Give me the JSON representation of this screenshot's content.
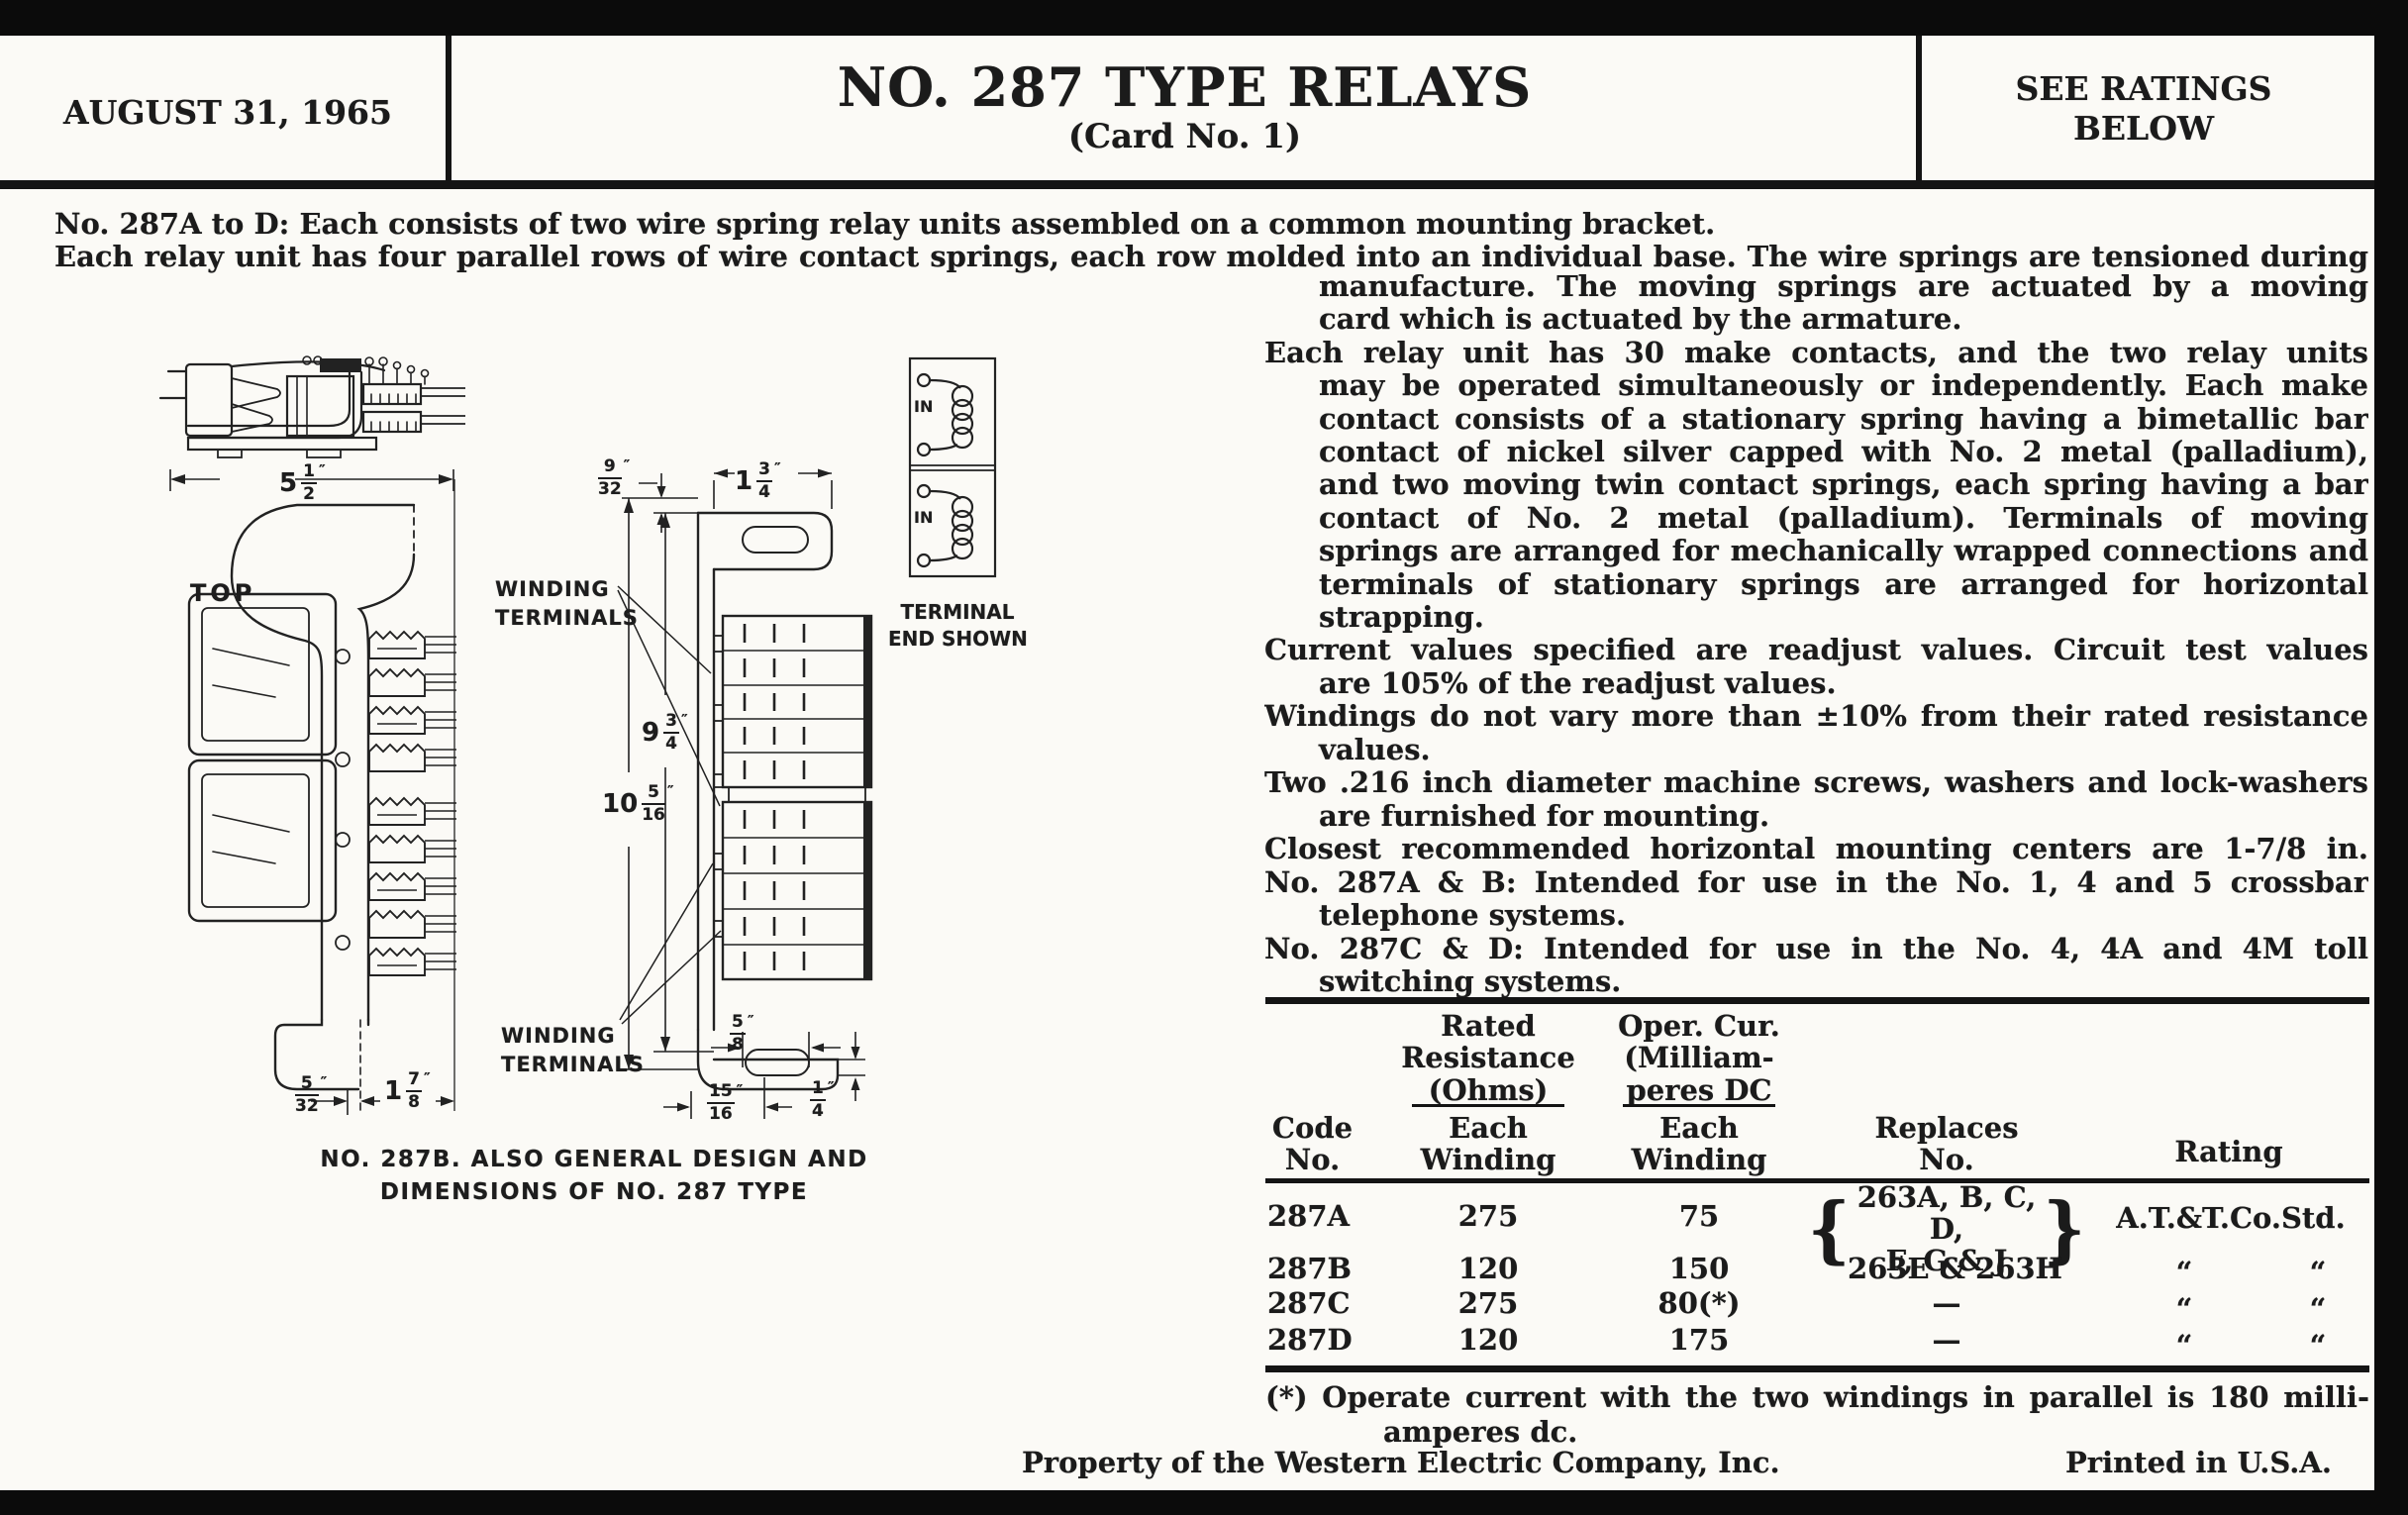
{
  "colors": {
    "paper": "#fbfaf6",
    "ink": "#1b1b1b",
    "border": "#0b0b0b"
  },
  "header": {
    "date": "AUGUST 31, 1965",
    "title": "NO. 287 TYPE RELAYS",
    "subtitle": "(Card No. 1)",
    "ratings_l1": "SEE RATINGS",
    "ratings_l2": "BELOW"
  },
  "intro": {
    "line1": "No. 287A to D:  Each consists of two wire spring relay units assembled on a common mounting bracket.",
    "line2": "Each relay unit has four parallel rows of wire contact springs, each row molded into an individual base.  The wire springs are tensioned during"
  },
  "column": {
    "lines": [
      "manufacture.  The moving springs are actuated by a moving",
      "card which is actuated by the armature.",
      "Each relay unit has 30 make contacts, and the two relay units",
      "may be operated simultaneously or independently.  Each make",
      "contact consists of a stationary spring having a bimetallic bar",
      "contact of nickel silver capped with No. 2 metal (palladium),",
      "and two moving twin contact springs, each spring having a bar",
      "contact of No. 2 metal (palladium).  Terminals of moving",
      "springs are arranged for mechanically wrapped connections and",
      "terminals of stationary springs are arranged for horizontal",
      "strapping.",
      "Current values specified are readjust values.  Circuit test values",
      "are 105% of the readjust values.",
      "Windings do not vary more than ±10% from their rated resistance",
      "values.",
      "Two .216 inch diameter machine screws, washers and lock-washers",
      "are furnished for mounting.",
      "Closest recommended horizontal mounting centers are 1-7/8 in.",
      "No. 287A & B:  Intended for use in the No. 1, 4 and 5 crossbar",
      "telephone systems.",
      "No. 287C & D:  Intended for use in the No. 4, 4A and 4M toll",
      "switching systems."
    ]
  },
  "drawing": {
    "top_view_label": "TOP",
    "winding_terminals_l1": "WINDING",
    "winding_terminals_l2": "TERMINALS",
    "terminal_end_l1": "TERMINAL",
    "terminal_end_l2": "END SHOWN",
    "coil_in": "IN",
    "caption_l1": "NO. 287B. ALSO GENERAL DESIGN AND",
    "caption_l2": "DIMENSIONS OF NO. 287 TYPE",
    "inch_mark": "″",
    "dims": {
      "overall_width": {
        "w": "5",
        "n": "1",
        "d": "2"
      },
      "bracket_offset": {
        "w": "",
        "n": "9",
        "d": "32"
      },
      "bracket_width": {
        "w": "1",
        "n": "3",
        "d": "4"
      },
      "terminal_span": {
        "w": "9",
        "n": "3",
        "d": "4"
      },
      "overall_height": {
        "w": "10",
        "n": "5",
        "d": "16"
      },
      "slot_width": {
        "w": "",
        "n": "5",
        "d": "8"
      },
      "slot_center": {
        "w": "",
        "n": "15",
        "d": "16"
      },
      "foot_offset": {
        "w": "",
        "n": "1",
        "d": "4"
      },
      "base_offset": {
        "w": "",
        "n": "5",
        "d": "32"
      },
      "depth": {
        "w": "1",
        "n": "7",
        "d": "8"
      }
    }
  },
  "table": {
    "headers": {
      "code_l1": "Code",
      "code_l2": "No.",
      "res_l1": "Rated",
      "res_l2": "Resistance",
      "res_l3": "(Ohms)",
      "cur_l1": "Oper. Cur.",
      "cur_l2": "(Milliam-",
      "cur_l3": "peres DC",
      "each": "Each",
      "winding": "Winding",
      "replaces_l1": "Replaces",
      "replaces_l2": "No.",
      "rating": "Rating"
    },
    "brace_open": "{",
    "brace_close": "}",
    "ditto": "“",
    "rows": [
      {
        "code": "287A",
        "res": "275",
        "cur": "75",
        "rep1": "263A, B, C, D,",
        "rep2": "F, G & J",
        "rating": "A.T.&T.Co.Std."
      },
      {
        "code": "287B",
        "res": "120",
        "cur": "150",
        "rep": "263E & 263H"
      },
      {
        "code": "287C",
        "res": "275",
        "cur": "80(*)",
        "rep": "—"
      },
      {
        "code": "287D",
        "res": "120",
        "cur": "175",
        "rep": "—"
      }
    ]
  },
  "footnote": {
    "line1": "(*)  Operate current with the two windings in parallel is 180 milli-",
    "line2": "amperes dc."
  },
  "footer": {
    "left": "Property of the Western Electric Company, Inc.",
    "right": "Printed in U.S.A."
  }
}
